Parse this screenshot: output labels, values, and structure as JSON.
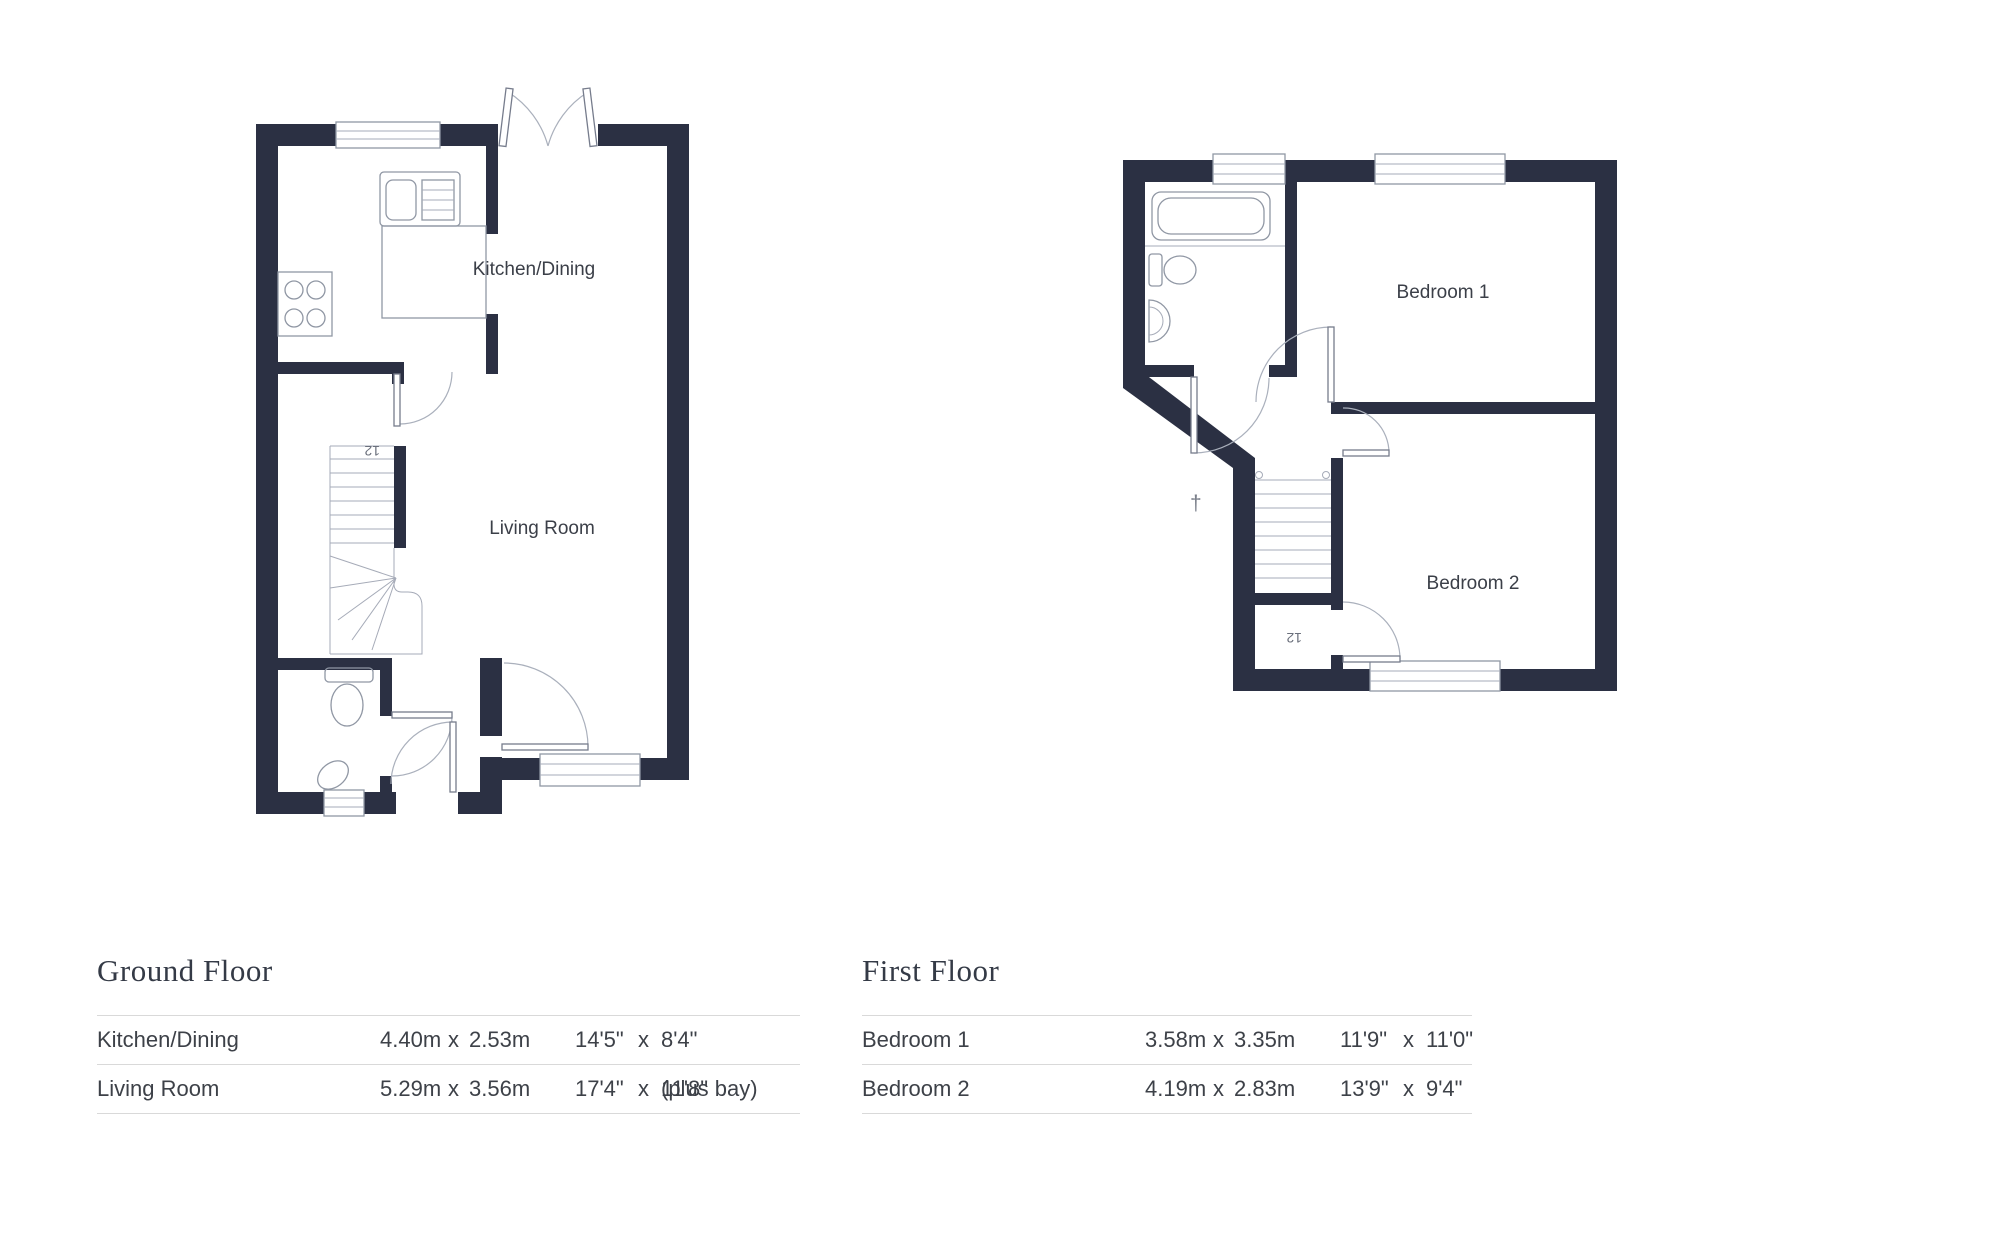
{
  "colors": {
    "wall": "#2b3043",
    "line": "#9097a4",
    "label": "#3b3f48"
  },
  "ground_plan": {
    "kitchen_label": "Kitchen/Dining",
    "living_label": "Living Room",
    "stairs_label": "12"
  },
  "first_plan": {
    "bedroom1_label": "Bedroom 1",
    "bedroom2_label": "Bedroom 2",
    "stairs_label": "12",
    "dagger": "†"
  },
  "tables": {
    "ground": {
      "heading": "Ground Floor",
      "rows": [
        {
          "name": "Kitchen/Dining",
          "m1": "4.40m",
          "mx": "x",
          "m2": "2.53m",
          "i1": "14'5\"",
          "ix": "x",
          "i2": "8'4\"",
          "suffix": ""
        },
        {
          "name": "Living Room",
          "m1": "5.29m",
          "mx": "x",
          "m2": "3.56m",
          "i1": "17'4\"",
          "ix": "x",
          "i2": "11'8\"",
          "suffix": "(plus bay)"
        }
      ]
    },
    "first": {
      "heading": "First Floor",
      "rows": [
        {
          "name": "Bedroom 1",
          "m1": "3.58m",
          "mx": "x",
          "m2": "3.35m",
          "i1": "11'9\"",
          "ix": "x",
          "i2": "11'0\"",
          "suffix": ""
        },
        {
          "name": "Bedroom 2",
          "m1": "4.19m",
          "mx": "x",
          "m2": "2.83m",
          "i1": "13'9\"",
          "ix": "x",
          "i2": "9'4\"",
          "suffix": ""
        }
      ]
    }
  }
}
